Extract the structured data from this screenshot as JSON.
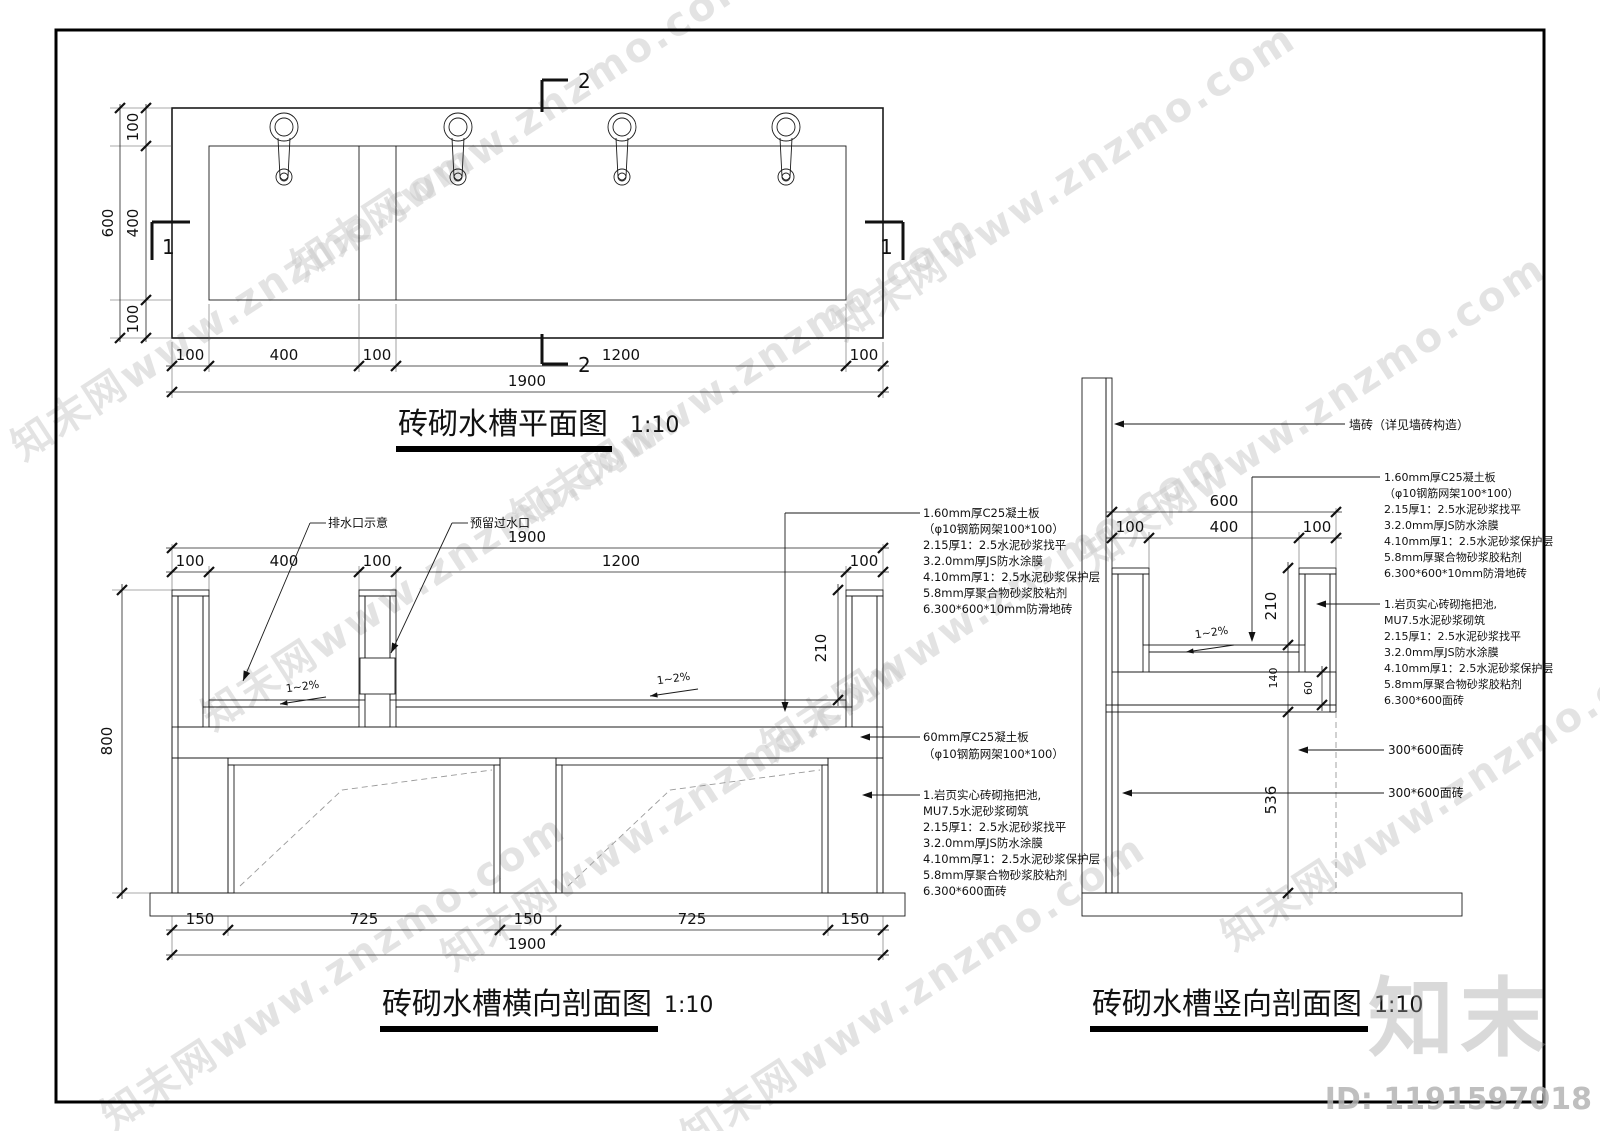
{
  "watermark": {
    "tile": "知末网www.znzmo.com",
    "logo": "知末",
    "id": "ID: 1191597018"
  },
  "plan": {
    "title": "砖砌水槽平面图",
    "scale": "1:10",
    "dim_total_width": "1900",
    "dims_width": [
      "100",
      "400",
      "100",
      "1200",
      "100"
    ],
    "dim_total_height": "600",
    "dims_height": [
      "100",
      "400",
      "100"
    ],
    "mark_section_2": "2",
    "mark_section_1": "1"
  },
  "cross": {
    "title": "砖砌水槽横向剖面图",
    "scale": "1:10",
    "dim_total_top": "1900",
    "dims_top": [
      "100",
      "400",
      "100",
      "1200",
      "100"
    ],
    "dims_bottom": [
      "150",
      "725",
      "150",
      "725",
      "150"
    ],
    "dim_total_bottom": "1900",
    "dim_height": "800",
    "dim_depth": "210",
    "slope": "1~2%",
    "leader_drain": "排水口示意",
    "leader_pass": "预留过水口",
    "notes_top": [
      "1.60mm厚C25凝土板",
      "（φ10钢筋网架100*100）",
      "2.15厚1：2.5水泥砂浆找平",
      "3.2.0mm厚JS防水涂膜",
      "4.10mm厚1：2.5水泥砂浆保护层",
      "5.8mm厚聚合物砂浆胶粘剂",
      "6.300*600*10mm防滑地砖"
    ],
    "note_mid": [
      "60mm厚C25凝土板",
      "（φ10钢筋网架100*100）"
    ],
    "notes_base": [
      "1.岩页实心砖砌拖把池,",
      "  MU7.5水泥砂浆砌筑",
      "2.15厚1：2.5水泥砂浆找平",
      "3.2.0mm厚JS防水涂膜",
      "4.10mm厚1：2.5水泥砂浆保护层",
      "5.8mm厚聚合物砂浆胶粘剂",
      "6.300*600面砖"
    ]
  },
  "vert": {
    "title": "砖砌水槽竖向剖面图",
    "scale": "1:10",
    "leader_wall": "墙砖（详见墙砖构造）",
    "dim_total": "600",
    "dims": [
      "100",
      "400",
      "100"
    ],
    "dim_depth": "210",
    "dim_140": "140",
    "dim_60": "60",
    "dim_536": "536",
    "slope": "1~2%",
    "notes_top": [
      "1.60mm厚C25凝土板",
      "（φ10钢筋网架100*100）",
      "2.15厚1：2.5水泥砂浆找平",
      "3.2.0mm厚JS防水涂膜",
      "4.10mm厚1：2.5水泥砂浆保护层",
      "5.8mm厚聚合物砂浆胶粘剂",
      "6.300*600*10mm防滑地砖"
    ],
    "notes_base": [
      "1.岩页实心砖砌拖把池,",
      "  MU7.5水泥砂浆砌筑",
      "2.15厚1：2.5水泥砂浆找平",
      "3.2.0mm厚JS防水涂膜",
      "4.10mm厚1：2.5水泥砂浆保护层",
      "5.8mm厚聚合物砂浆胶粘剂",
      "6.300*600面砖"
    ],
    "leader_tile_1": "300*600面砖",
    "leader_tile_2": "300*600面砖"
  }
}
